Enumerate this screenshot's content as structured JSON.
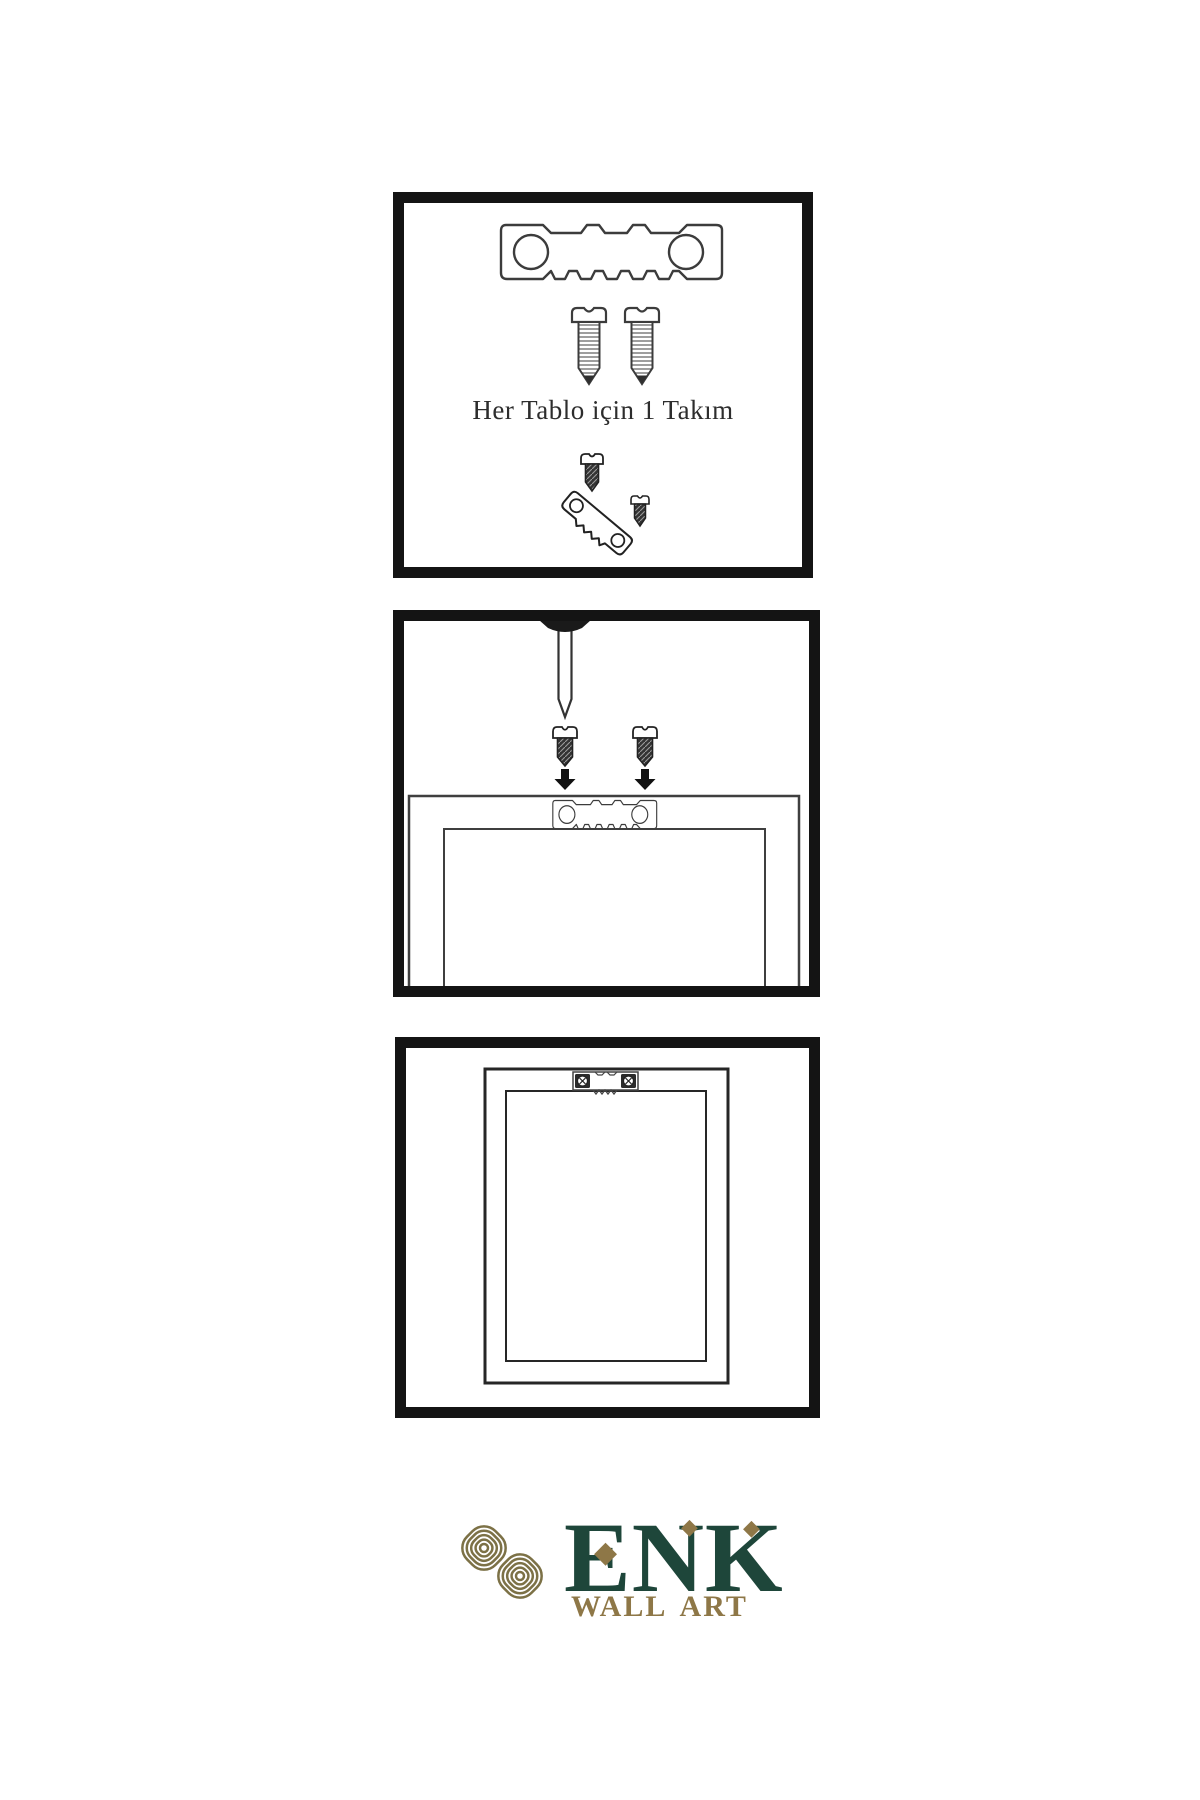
{
  "theme": {
    "bg": "#ffffff",
    "ink": "#3c3c3c",
    "ink-dark": "#1d1d1d",
    "panel-border": "#141414",
    "green": "#1e463a",
    "gold": "#8e7747",
    "knot": "#7c7146",
    "caption": "#2d2d2d"
  },
  "instructions": {
    "step1": {
      "name": "hanging kit contents",
      "caption": "Her Tablo için 1 Takım"
    },
    "step2": {
      "name": "screw hanger to frame back under wall nail"
    },
    "step3": {
      "name": "frame hung on wall"
    }
  },
  "logo": {
    "brand": "ENK",
    "subtitle": "WALL ART",
    "diamond": "◆"
  },
  "icons": {
    "sawtooth-hanger-icon": "metal plate with sawtooth edge and two holes (svg shape)",
    "screw-icon": "threaded screw (svg shape)",
    "dark-screw-icon": "dark hatched screw (svg shape)",
    "nail-icon": "wall nail (svg shape)",
    "arrow-down-icon": "solid downward arrow (svg shape)",
    "picture-frame-icon": "rectangular picture frame (svg shape)",
    "phillips-screw-head-icon": "circled cross screw head (svg shape)",
    "knot-logo-icon": "interlaced guilloche knot (svg shape)",
    "diamond-icon": "◆"
  }
}
